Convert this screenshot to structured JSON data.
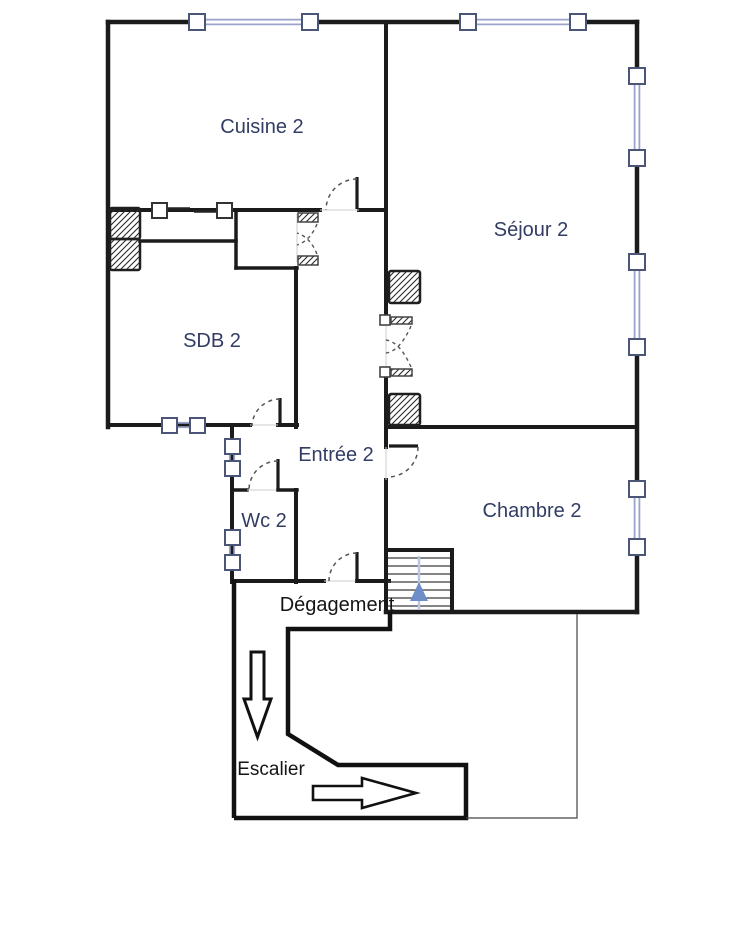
{
  "floor_plan": {
    "title": "Floor plan – level 2",
    "labels": {
      "cuisine": "Cuisine 2",
      "sejour": "Séjour 2",
      "sdb": "SDB 2",
      "entree": "Entrée 2",
      "wc": "Wc 2",
      "chambre": "Chambre 2",
      "degagement": "Dégagement",
      "escalier": "Escalier"
    },
    "colors": {
      "wall": "#1b1b1b",
      "window_line": "#9aa3c9",
      "window_frame": "#4a5578",
      "room_label": "#333c64",
      "annotation_label": "#151515",
      "stair_arrow_fill": "#6d8ec9",
      "stair_arrow_line": "#b8c6e4",
      "background": "#ffffff"
    }
  }
}
